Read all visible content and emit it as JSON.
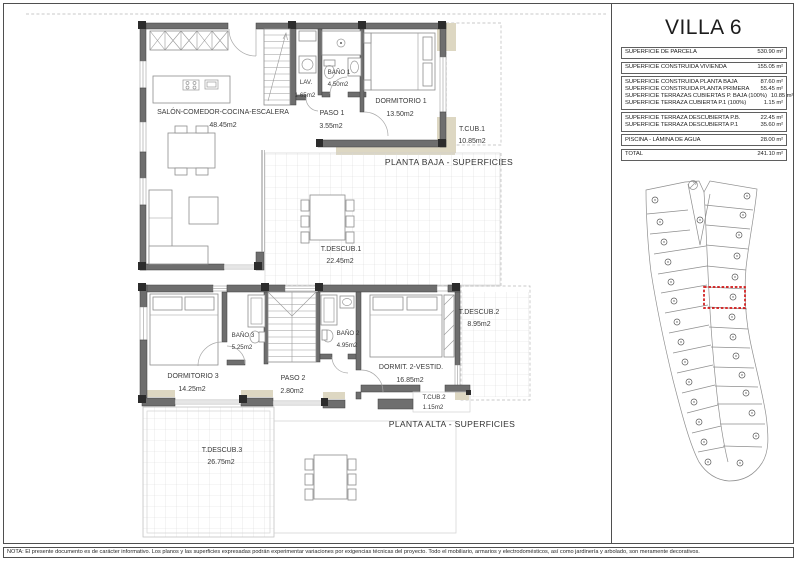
{
  "title": "VILLA 6",
  "surface_table": {
    "groups": [
      {
        "rows": [
          {
            "label": "SUPERFICIE DE PARCELA",
            "value": "530.90 m²"
          }
        ]
      },
      {
        "rows": [
          {
            "label": "SUPERFICIE CONSTRUIDA VIVIENDA",
            "value": "155.05 m²"
          }
        ]
      },
      {
        "rows": [
          {
            "label": "SUPERFICIE CONSTRUIDA PLANTA BAJA",
            "value": "87.60 m²"
          },
          {
            "label": "SUPERFICIE CONSTRUIDA PLANTA PRIMERA",
            "value": "55.45 m²"
          },
          {
            "label": "SUPERFICIE TERRAZAS CUBIERTAS P. BAJA (100%)",
            "value": "10.85 m²"
          },
          {
            "label": "SUPERFICIE TERRAZA CUBIERTA P.1 (100%)",
            "value": "1.15 m²"
          }
        ]
      },
      {
        "rows": [
          {
            "label": "SUPERFICIE TERRAZA DESCUBIERTA P.B.",
            "value": "22.45 m²"
          },
          {
            "label": "SUPERFICIE TERRAZA DESCUBIERTA P.1",
            "value": "35.60 m²"
          }
        ]
      },
      {
        "rows": [
          {
            "label": "PISCINA - LÁMINA DE AGUA",
            "value": "28.00 m²"
          }
        ]
      },
      {
        "rows": [
          {
            "label": "TOTAL",
            "value": "241.10 m²"
          }
        ]
      }
    ]
  },
  "plans": {
    "baja": {
      "title": "PLANTA BAJA - SUPERFICIES",
      "rooms": [
        {
          "name": "SALÓN-COMEDOR-COCINA-ESCALERA",
          "area": "48.45m2"
        },
        {
          "name": "LAV.",
          "area": "1.65m2"
        },
        {
          "name": "BAÑO 1",
          "area": "4.50m2"
        },
        {
          "name": "PASO 1",
          "area": "3.55m2"
        },
        {
          "name": "DORMITORIO 1",
          "area": "13.50m2"
        },
        {
          "name": "T.CUB.1",
          "area": "10.85m2"
        },
        {
          "name": "T.DESCUB.1",
          "area": "22.45m2"
        }
      ]
    },
    "alta": {
      "title": "PLANTA ALTA - SUPERFICIES",
      "rooms": [
        {
          "name": "DORMITORIO 3",
          "area": "14.25m2"
        },
        {
          "name": "BAÑO 3",
          "area": "5.25m2"
        },
        {
          "name": "PASO 2",
          "area": "2.80m2"
        },
        {
          "name": "BAÑO 2",
          "area": "4.95m2"
        },
        {
          "name": "DORMIT. 2-VESTID.",
          "area": "16.85m2"
        },
        {
          "name": "T.DESCUB.2",
          "area": "8.95m2"
        },
        {
          "name": "T.CUB.2",
          "area": "1.15m2"
        },
        {
          "name": "T.DESCUB.3",
          "area": "26.75m2"
        }
      ]
    }
  },
  "footer": {
    "note": "NOTA: El presente documento es de carácter informativo. Los planos y las superficies expresadas podrán experimentar variaciones por exigencias técnicas del proyecto. Todo el mobiliario, armarios y electrodomésticos, así como jardinería y arbolado, son meramente decorativos."
  }
}
